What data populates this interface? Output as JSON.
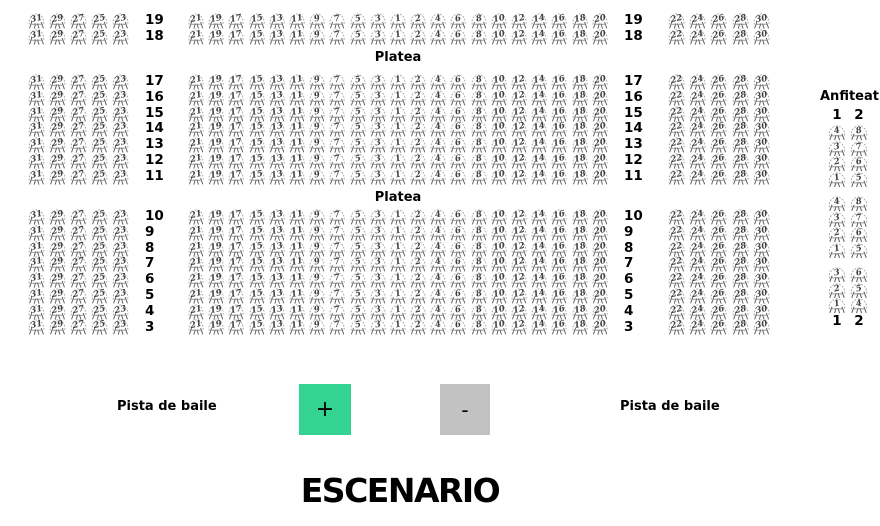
{
  "seat_map": {
    "platea_label": "Platea",
    "row_sections": [
      {
        "rows": [
          "19",
          "18"
        ],
        "platea_label_below": true
      },
      {
        "rows": [
          "17",
          "16",
          "15",
          "14",
          "13",
          "12",
          "11"
        ],
        "platea_label_below": true
      },
      {
        "rows": [
          "10",
          "9",
          "8",
          "7",
          "6",
          "5",
          "4",
          "3"
        ],
        "platea_label_below": false
      }
    ],
    "left_block_seats": [
      "31",
      "29",
      "27",
      "25",
      "23"
    ],
    "center_block_seats": [
      "21",
      "19",
      "17",
      "15",
      "13",
      "11",
      "9",
      "7",
      "5",
      "3",
      "1",
      "2",
      "4",
      "6",
      "8",
      "10",
      "12",
      "14",
      "16",
      "18",
      "20"
    ],
    "right_block_seats": [
      "22",
      "24",
      "26",
      "28",
      "30"
    ]
  },
  "anfiteatro": {
    "label": "Anfiteatro",
    "column_headers": [
      "1",
      "2"
    ],
    "column_footers": [
      "1",
      "2"
    ],
    "groups": [
      {
        "columns": [
          [
            "4",
            "3",
            "2",
            "1"
          ],
          [
            "8",
            "7",
            "6",
            "5"
          ]
        ]
      },
      {
        "columns": [
          [
            "4",
            "3",
            "2",
            "1"
          ],
          [
            "8",
            "7",
            "6",
            "5"
          ]
        ]
      },
      {
        "columns": [
          [
            "3",
            "2",
            "1"
          ],
          [
            "6",
            "5",
            "4"
          ]
        ]
      }
    ]
  },
  "dance_floor": {
    "left_label": "Pista de baile",
    "right_label": "Pista de baile"
  },
  "zoom_controls": {
    "zoom_in_label": "+",
    "zoom_out_label": "-",
    "zoom_in_color": "#35d391",
    "zoom_out_color": "#c2c2c2"
  },
  "stage": {
    "label": "ESCENARIO"
  },
  "seat_icon": "chair-icon"
}
